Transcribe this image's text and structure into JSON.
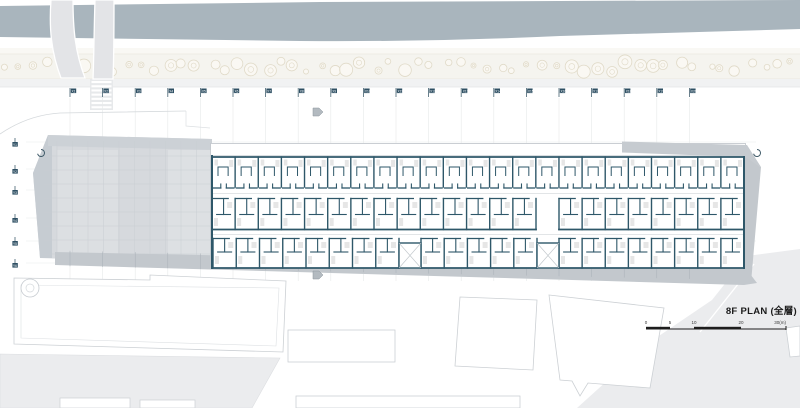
{
  "title": {
    "label": "8F PLAN (全層)"
  },
  "scalebar": {
    "labels": [
      "0",
      "5",
      "10",
      "20",
      "30(m)"
    ],
    "positions": [
      646,
      670,
      694,
      741,
      786
    ]
  },
  "grid": {
    "x_labels": [
      "X1",
      "X2",
      "X3",
      "X4",
      "X5",
      "X6",
      "X7",
      "X8",
      "X9",
      "X10",
      "X11",
      "X12",
      "X13",
      "X14",
      "X15",
      "X16",
      "X17",
      "X18",
      "X19",
      "X20"
    ],
    "x_start": 70,
    "x_step": 32.6,
    "x_row_y": 88,
    "y_labels": [
      "Y1",
      "Y2",
      "Y3",
      "Y4",
      "Y5",
      "Y6"
    ],
    "y_positions": [
      142,
      169,
      190,
      218,
      241,
      263
    ],
    "y_col_x": 15
  },
  "plan": {
    "building": {
      "x0": 212,
      "x1": 744,
      "top": 143,
      "bottom": 269
    },
    "unit_width": 23.13,
    "rows": [
      {
        "type": "top",
        "y0": 156,
        "y1": 190,
        "segments": [
          [
            212,
            744
          ]
        ]
      },
      {
        "type": "mid",
        "y0": 198,
        "y1": 230,
        "segments": [
          [
            212,
            536
          ],
          [
            559,
            744
          ]
        ]
      },
      {
        "type": "bot",
        "y0": 238,
        "y1": 268,
        "segments": [
          [
            213,
            399
          ],
          [
            421,
            537
          ],
          [
            559,
            744
          ]
        ]
      }
    ],
    "cores": [
      [
        399,
        243,
        22,
        25
      ],
      [
        537,
        243,
        22,
        25
      ]
    ],
    "trees": {
      "count": 58,
      "band_top": 54,
      "band_bottom": 79
    }
  },
  "markers": {
    "section_arrows": [
      [
        313,
        108
      ],
      [
        313,
        271
      ]
    ],
    "spirals": [
      [
        41,
        153
      ],
      [
        757,
        153
      ]
    ]
  },
  "colors": {
    "river": "#a9b5bd",
    "tree_band": "#f5f4ef",
    "tree_stroke": "#e0dac8",
    "road_band": "#f1f2f3",
    "ramp": "#e3e4e7",
    "site_gray": "#d6d9dd",
    "edge_gray": "#c6ccd2",
    "band_gray": "#c3c8cd",
    "wall": "#2e5769",
    "road_gray": "#ebecee",
    "outline": "#ccd0d4",
    "grid_line": "#e7e9ea",
    "flag": "#2e4f63",
    "furniture": "#d9d9d9",
    "scale_ink": "#1d1d1d"
  }
}
